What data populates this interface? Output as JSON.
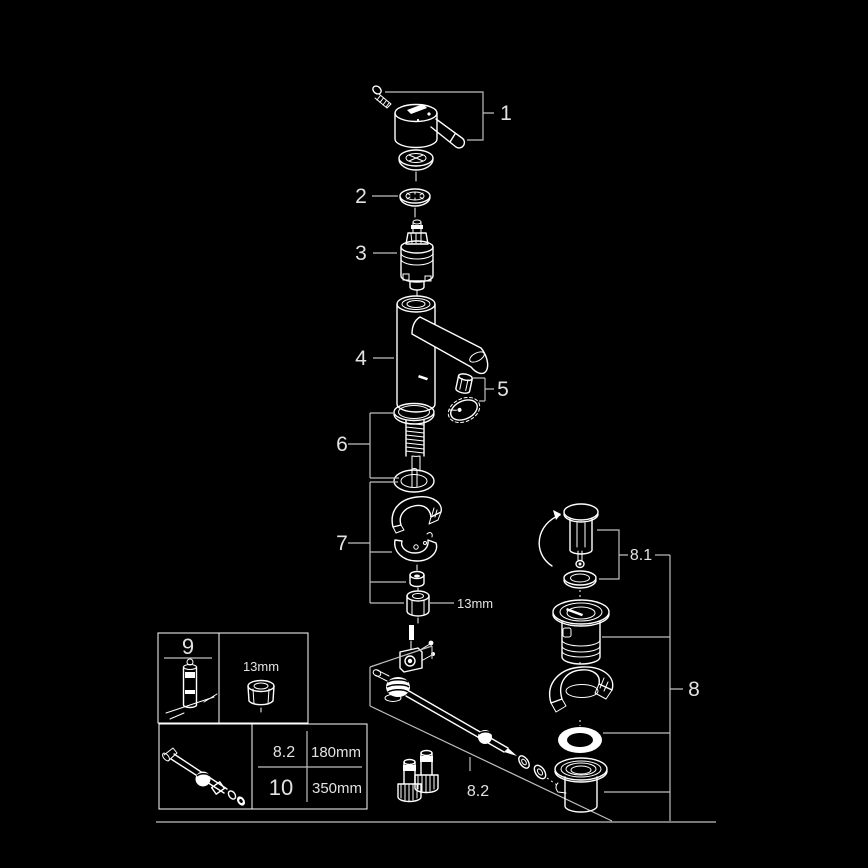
{
  "diagram": {
    "kind": "exploded-parts-diagram",
    "colors": {
      "background": "#000000",
      "line": "#ffffff",
      "label": "#e2e2e2",
      "bracket": "#bfbfbf"
    },
    "callouts": {
      "part1": "1",
      "part2": "2",
      "part3": "3",
      "part4": "4",
      "part5": "5",
      "part6": "6",
      "part7": "7",
      "part8": "8",
      "part8_1": "8.1",
      "part8_2": "8.2",
      "wrench_size": "13mm"
    }
  },
  "info_table": {
    "tool_ref": "9",
    "tool_wrench_size": "13mm",
    "rows": [
      {
        "ref": "8.2",
        "length": "180mm"
      },
      {
        "ref": "10",
        "length": "350mm"
      }
    ]
  }
}
